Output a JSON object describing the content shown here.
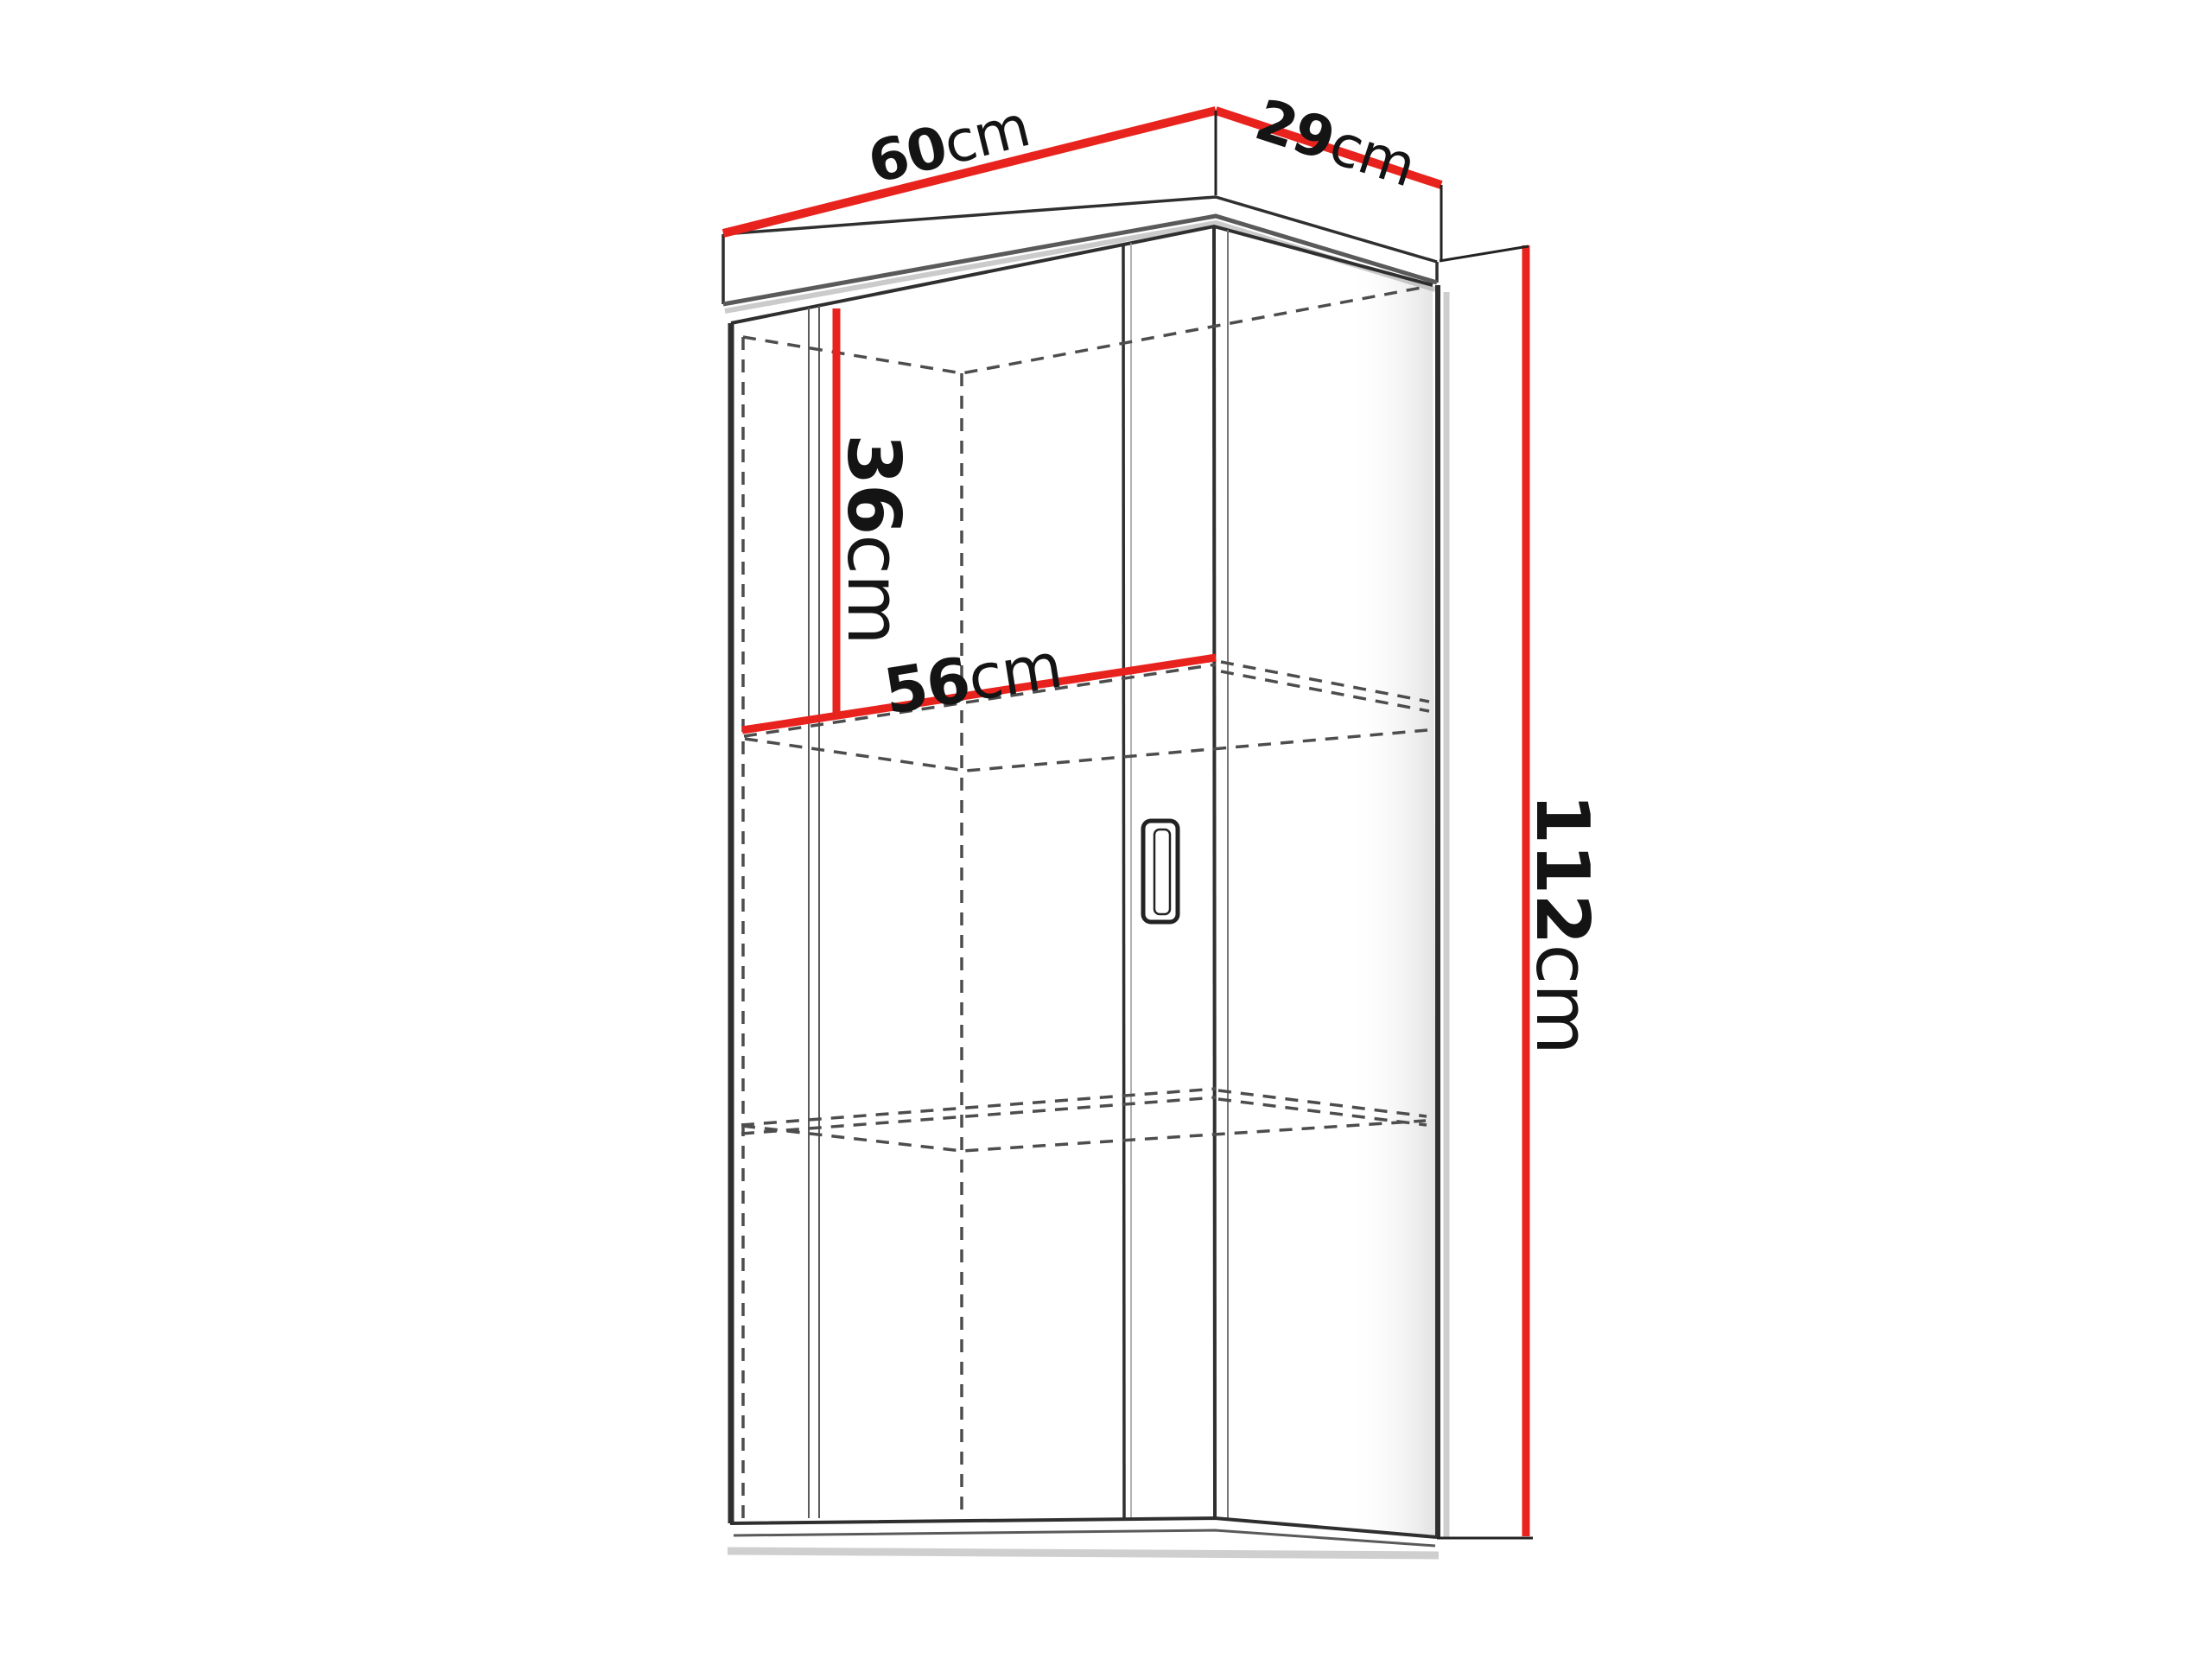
{
  "diagram": {
    "kind": "furniture-dimension-diagram",
    "subject": "wall cabinet with interior shelves, 3d line drawing"
  },
  "labels": {
    "width": {
      "value": "60",
      "unit": "cm"
    },
    "depth": {
      "value": "29",
      "unit": "cm"
    },
    "height": {
      "value": "112",
      "unit": "cm"
    },
    "upper_section_height": {
      "value": "36",
      "unit": "cm"
    },
    "shelf_width": {
      "value": "56",
      "unit": "cm"
    }
  },
  "colors": {
    "dimension_line": "#e8231e",
    "outline": "#2f2f2f",
    "hidden_line": "#4d4d4d",
    "background": "#ffffff"
  }
}
